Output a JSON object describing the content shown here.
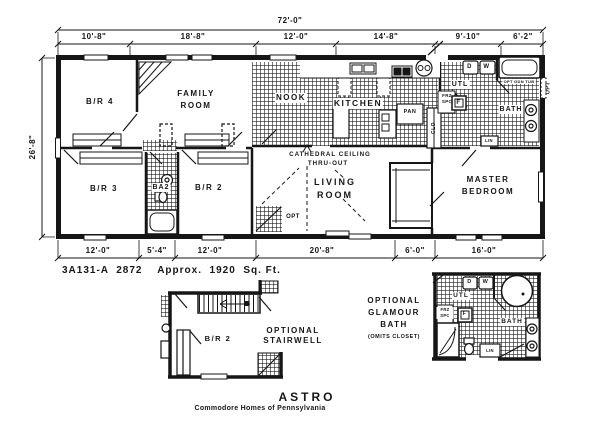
{
  "drawing": {
    "dimensions": {
      "overall_width": "72'-0\"",
      "overall_depth": "26'-8\"",
      "top": [
        "10'-8\"",
        "18'-8\"",
        "12'-0\"",
        "14'-8\"",
        "9'-10\"",
        "6'-2\""
      ],
      "bottom": [
        "12'-0\"",
        "5'-4\"",
        "12'-0\"",
        "20'-8\"",
        "6'-0\"",
        "16'-0\""
      ]
    },
    "rooms": {
      "br4": "B/R 4",
      "family": "FAMILY ROOM",
      "nook": "NOOK",
      "kitchen": "KITCHEN",
      "br3": "B/R 3",
      "ba2": "BA2",
      "br2": "B/R 2",
      "living": "LIVING ROOM",
      "master": "MASTER BEDROOM",
      "utility": "UTL",
      "bath": "BATH"
    },
    "labels": {
      "pantry": "PAN",
      "closet": "CLO",
      "dryer": "D",
      "washer": "W",
      "freezer": "FRZ SPC",
      "furnace": "F",
      "garden_tub": "OPT GDN TUB",
      "linen": "LIN",
      "optional": "OPT",
      "cathedral_line1": "CATHEDRAL CEILING",
      "cathedral_line2": "THRU-OUT"
    },
    "model_line": "3A131-A  2872    Approx.  1920  Sq. Ft."
  },
  "options": {
    "stairwell": {
      "line1": "OPTIONAL",
      "line2": "STAIRWELL",
      "room": "B/R 2"
    },
    "glamour_bath": {
      "line1": "OPTIONAL",
      "line2": "GLAMOUR",
      "line3": "BATH",
      "line4": "(OMITS CLOSET)"
    }
  },
  "footer": {
    "title": "ASTRO",
    "subtitle": "Commodore Homes of Pennsylvania"
  }
}
